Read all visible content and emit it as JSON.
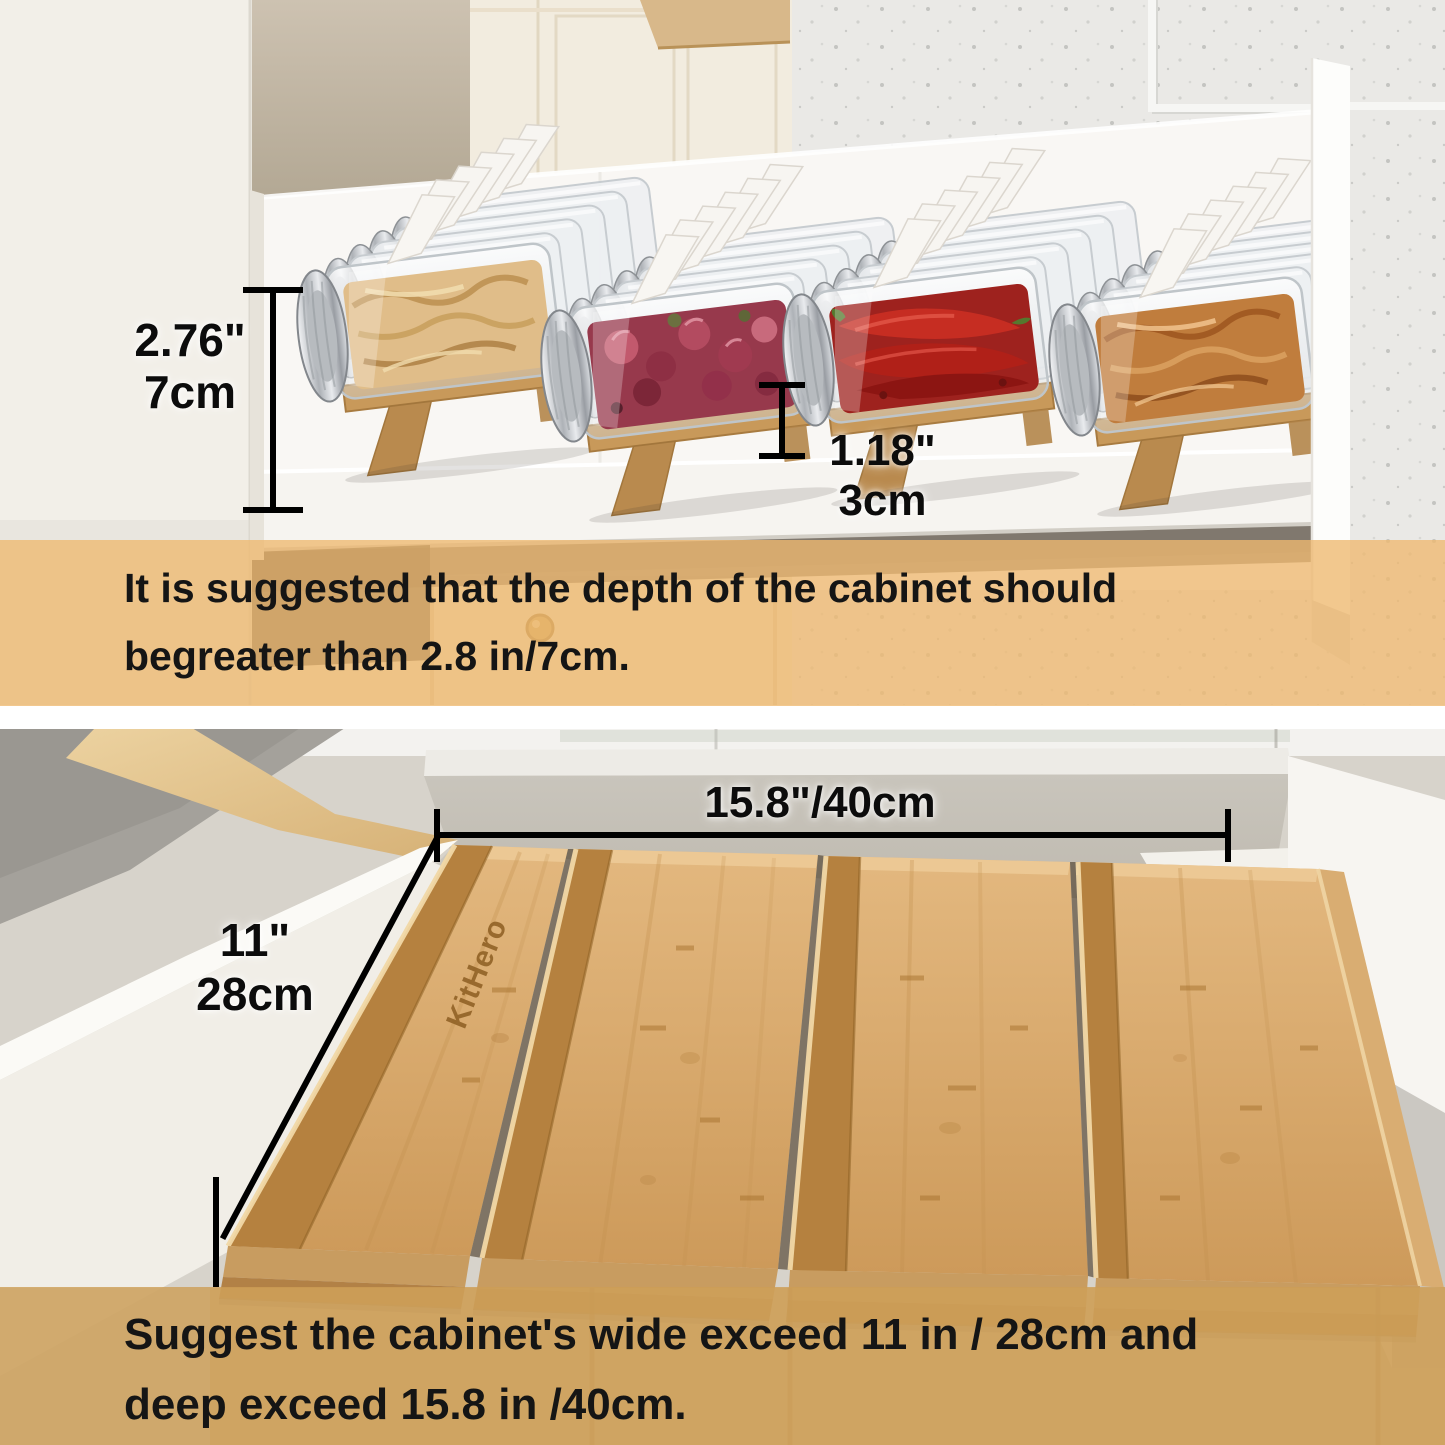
{
  "top_section": {
    "dimension_jar_height": {
      "inches": "2.76\"",
      "metric": "7cm"
    },
    "dimension_riser_height": {
      "inches": "1.18\"",
      "metric": "3cm"
    },
    "caption": {
      "line1": "It is suggested that the depth of the cabinet should",
      "line2": "begreater than 2.8 in/7cm."
    }
  },
  "bottom_section": {
    "brand_engraving": "KitHero",
    "dimension_depth": "15.8\"/40cm",
    "dimension_width": {
      "inches": "11\"",
      "metric": "28cm"
    },
    "caption": {
      "line1": "Suggest the cabinet's wide exceed 11 in / 28cm and",
      "line2": "deep exceed 15.8 in /40cm."
    }
  },
  "colors": {
    "banner_top": "#eeb870",
    "banner_bottom": "#cd9e55",
    "bamboo": "#d2a263",
    "annotation_text": "#0c0c0c"
  }
}
